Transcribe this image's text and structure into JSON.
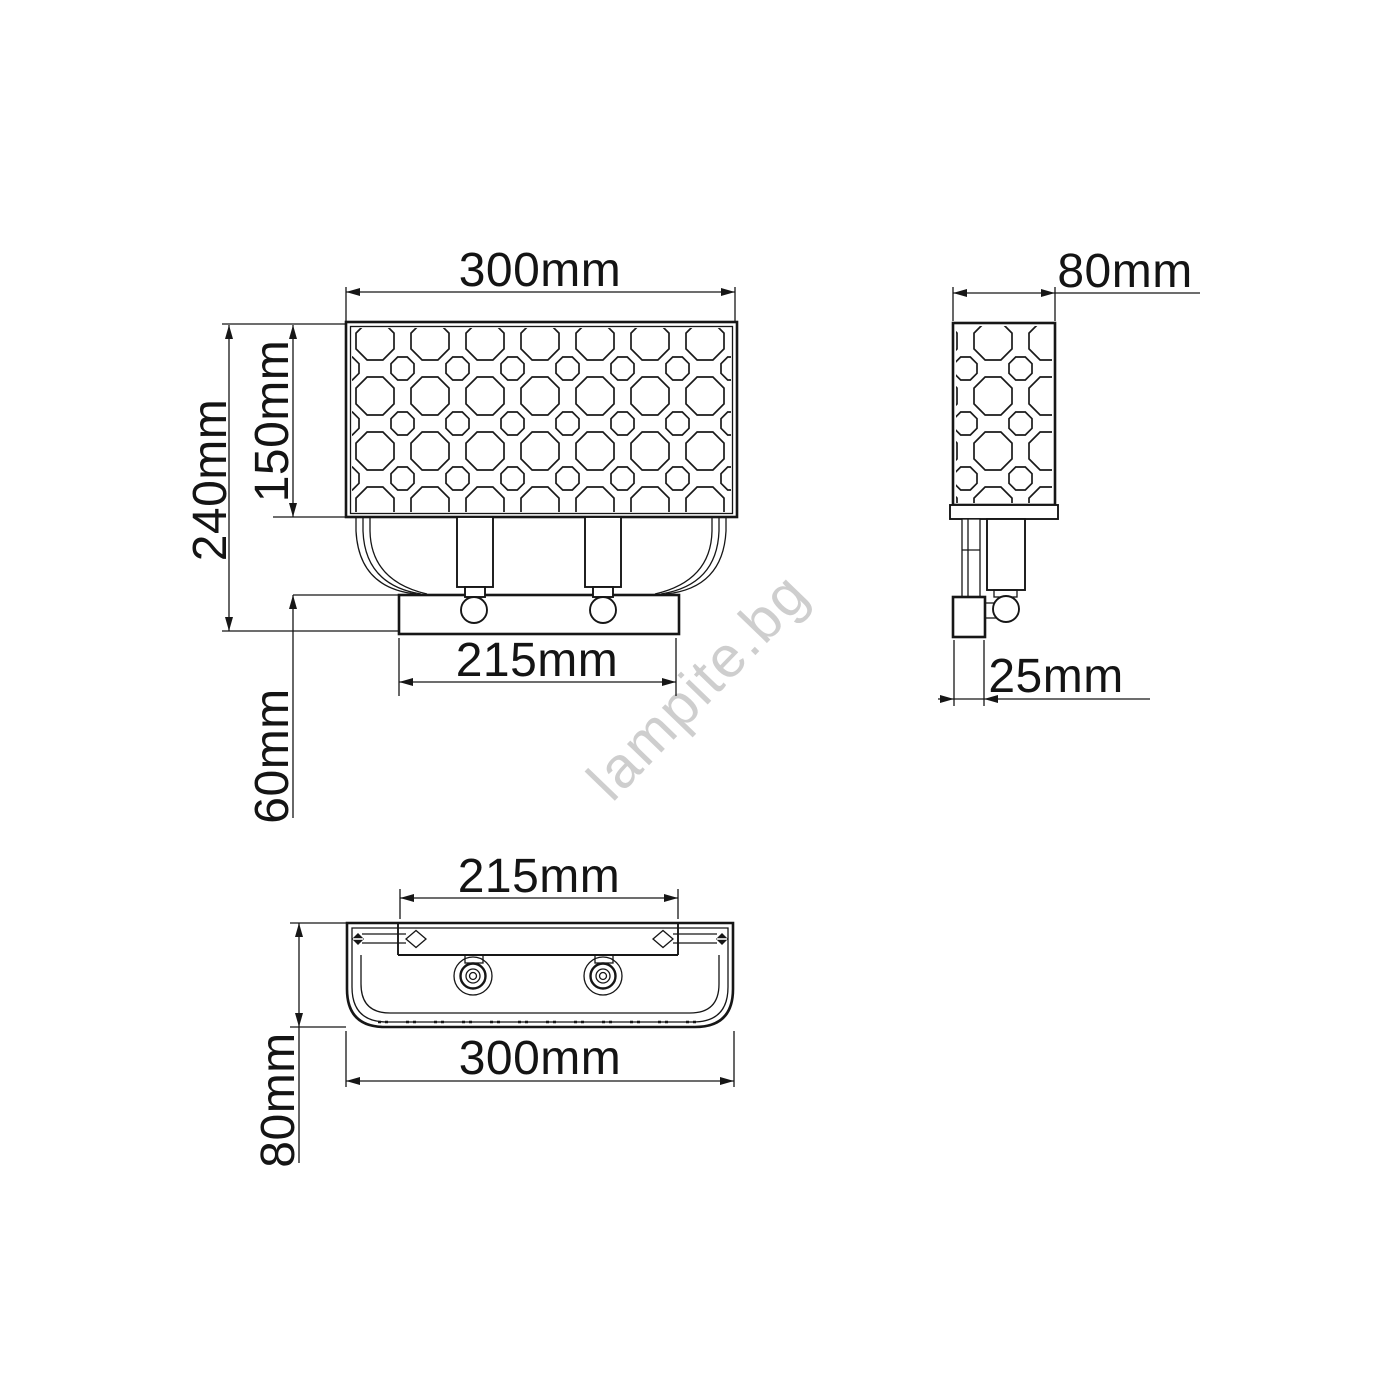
{
  "drawing": {
    "title": "wall-lamp-dimension-drawing",
    "views": {
      "front": {
        "width_label": "300mm",
        "total_height_label": "240mm",
        "shade_height_label": "150mm",
        "base_width_label": "215mm",
        "drop_label": "60mm"
      },
      "side": {
        "depth_label": "80mm",
        "backplate_label": "25mm"
      },
      "bottom": {
        "mount_spacing_label": "215mm",
        "width_label": "300mm",
        "depth_label": "80mm"
      }
    },
    "watermark": {
      "text": "lampite.bg",
      "color": "#c9c9c9"
    },
    "colors": {
      "line": "#161616",
      "background": "#ffffff",
      "watermark": "#c9c9c9"
    }
  }
}
